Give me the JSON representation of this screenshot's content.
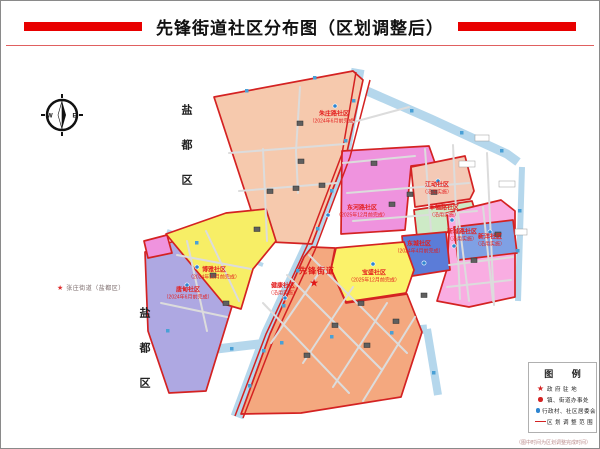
{
  "title": "先锋街道社区分布图（区划调整后）",
  "compass": {
    "west": "W",
    "east": "E"
  },
  "district_labels": [
    "盐都区",
    "盐都区"
  ],
  "neighbor_street": {
    "star": "★",
    "label": "张庄街道（盐都区）"
  },
  "street_office": {
    "name": "先锋街道",
    "star": "★"
  },
  "communities": [
    {
      "name": "朱庄路社区",
      "note": "（2024年6月前完成）",
      "color": "#f6c9ad"
    },
    {
      "name": "东河路社区",
      "note": "（2025年12月前完成）",
      "color": "#ef93de"
    },
    {
      "name": "江动社区",
      "note": "（沿用实施）",
      "color": "#f4c9b6"
    },
    {
      "name": "幸福路社区",
      "note": "（沿用实施）",
      "color": "#cdeac6"
    },
    {
      "name": "东城社区",
      "note": "（2024年4月前完成）",
      "color": "#5b7cd8"
    },
    {
      "name": "新城路社区",
      "note": "（沿用实施）",
      "color": "#f9ade2"
    },
    {
      "name": "新洋社区",
      "note": "（沿用实施）",
      "color": "#7fa0e4"
    },
    {
      "name": "唐甸社区",
      "note": "（2024年6月前完成）",
      "color": "#aea8e2"
    },
    {
      "name": "博雅社区",
      "note": "（2024年12月前完成）",
      "color": "#f7ee66"
    },
    {
      "name": "健康社区",
      "note": "（沿用实施）",
      "color": "#f4a87f"
    },
    {
      "name": "宝盛社区",
      "note": "（2025年12月前完成）",
      "color": "#fbf26a"
    }
  ],
  "map_colors": {
    "river": "#b5d7ec",
    "boundary": "#d42222",
    "patch": "#ef93de"
  },
  "legend": {
    "title": "图  例",
    "items": [
      {
        "symbol": "red-star",
        "label": "政 府 驻 地"
      },
      {
        "symbol": "red-dot",
        "label": "镇、街道办事处"
      },
      {
        "symbol": "blue-dot",
        "label": "行政村、社区居委会"
      },
      {
        "symbol": "red-line",
        "label": "区 划 调 整 范 围"
      }
    ]
  },
  "footnote": "（图中时间为区划调整完成时间）"
}
